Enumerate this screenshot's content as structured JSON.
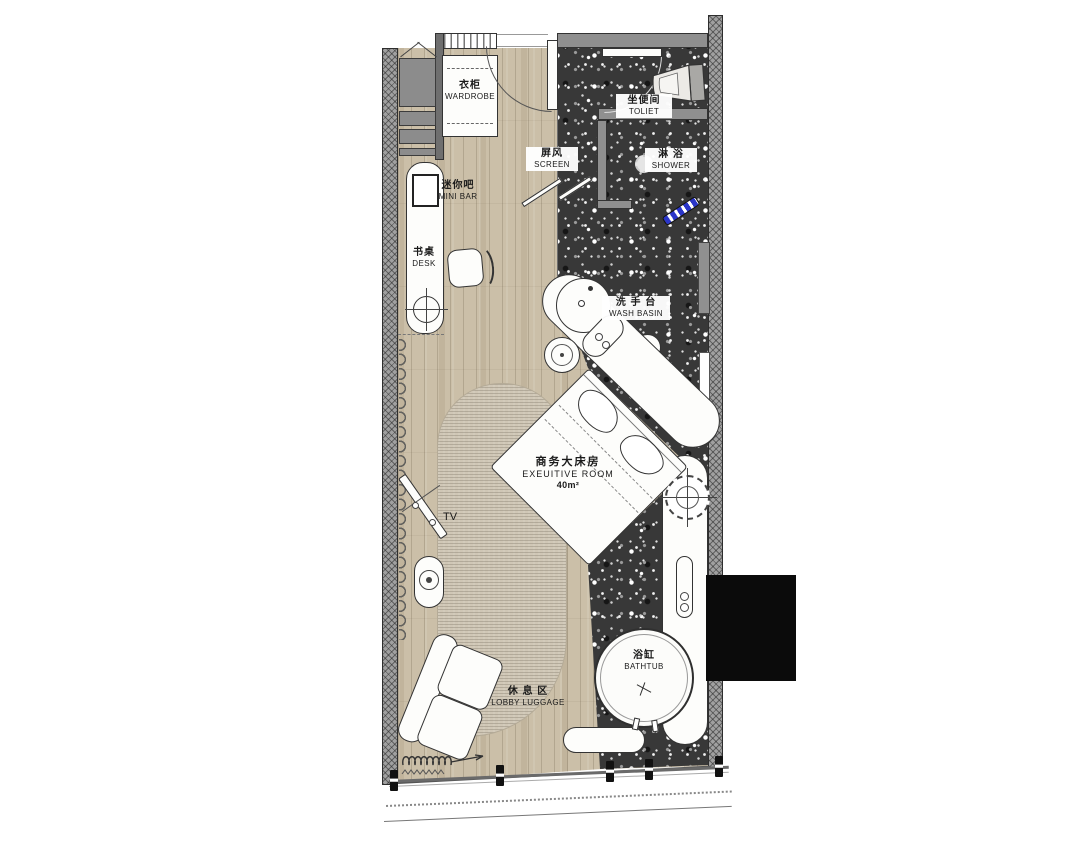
{
  "labels": {
    "wardrobe": {
      "zh": "衣柜",
      "en": "WARDROBE"
    },
    "minibar": {
      "zh": "迷你吧",
      "en": "MINI BAR"
    },
    "desk": {
      "zh": "书桌",
      "en": "DESK"
    },
    "screen": {
      "zh": "屏风",
      "en": "SCREEN"
    },
    "toilet": {
      "zh": "坐便间",
      "en": "TOLIET"
    },
    "shower": {
      "zh": "淋 浴",
      "en": "SHOWER"
    },
    "wash_basin": {
      "zh": "洗 手 台",
      "en": "WASH BASIN"
    },
    "room": {
      "zh": "商务大床房",
      "en": "EXEUITIVE ROOM",
      "area": "40m²"
    },
    "tv": {
      "en": "TV"
    },
    "lounge": {
      "zh": "休 息 区",
      "en": "LOBBY LUGGAGE"
    },
    "bathtub": {
      "zh": "浴缸",
      "en": "BATHTUB"
    }
  },
  "colors": {
    "wood_floor": "#cbbfa8",
    "terrazzo_floor": "#383838",
    "carpet": "#d0c7b6",
    "wall_grey": "#9e9e9e",
    "shower_wand_blue": "#2a35c8",
    "redaction_black": "#0b0b0b"
  }
}
